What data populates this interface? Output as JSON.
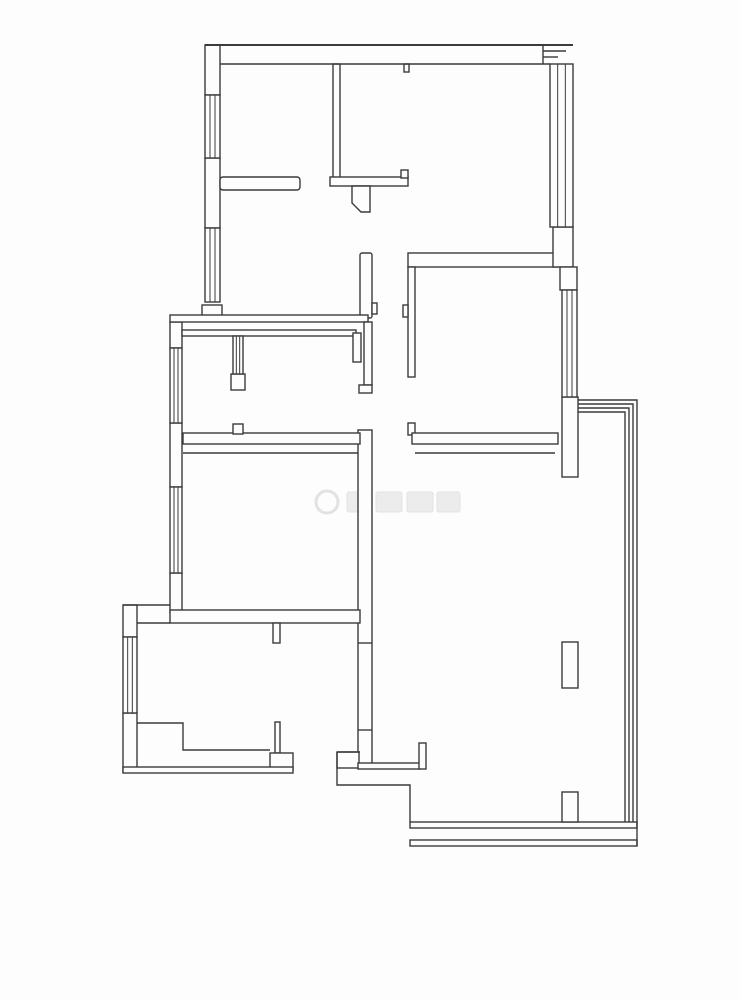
{
  "meta": {
    "title": "apartment-floor-plan"
  },
  "canvas": {
    "w": 740,
    "h": 1000,
    "background": "#fdfdfd",
    "stroke": "#3b3b3b",
    "stroke_thin": 1.4,
    "stroke_thick": 2
  },
  "floorplan": {
    "wall_rects": [
      {
        "name": "wall-left-top-block",
        "x": 205,
        "y": 45,
        "w": 15,
        "h": 50
      },
      {
        "name": "wall-left-mid-block",
        "x": 205,
        "y": 158,
        "w": 15,
        "h": 70
      },
      {
        "name": "wall-left-step-block",
        "x": 202,
        "y": 305,
        "w": 20,
        "h": 12
      },
      {
        "name": "wall-left2-upper-block",
        "x": 170,
        "y": 322,
        "w": 12,
        "h": 26
      },
      {
        "name": "wall-left2-mid-block",
        "x": 170,
        "y": 423,
        "w": 12,
        "h": 64
      },
      {
        "name": "wall-left2-lower-block",
        "x": 170,
        "y": 573,
        "w": 12,
        "h": 40
      },
      {
        "name": "wall-left3-upper-block",
        "x": 123,
        "y": 605,
        "w": 14,
        "h": 32
      },
      {
        "name": "wall-left3-lower-block",
        "x": 123,
        "y": 713,
        "w": 14,
        "h": 59
      },
      {
        "name": "wall-bedroom1-bottom",
        "x": 220,
        "y": 177,
        "w": 80,
        "h": 13,
        "rx": 3
      },
      {
        "name": "wall-partition-top",
        "x": 333,
        "y": 64,
        "w": 7,
        "h": 114
      },
      {
        "name": "wall-hall-bar",
        "x": 330,
        "y": 177,
        "w": 78,
        "h": 9
      },
      {
        "name": "wall-hall-bar-hook",
        "x": 401,
        "y": 170,
        "w": 7,
        "h": 8
      },
      {
        "name": "door-stop-top",
        "x": 404,
        "y": 64,
        "w": 5,
        "h": 8
      },
      {
        "name": "wall-hall-jamb",
        "x": 360,
        "y": 253,
        "w": 12,
        "h": 65,
        "rx": 2
      },
      {
        "name": "door-hinge-hall",
        "x": 372,
        "y": 303,
        "w": 5,
        "h": 11
      },
      {
        "name": "wall-dining-bottom-outer",
        "x": 170,
        "y": 315,
        "w": 198,
        "h": 7
      },
      {
        "name": "wall-dining-bottom-inner",
        "x": 182,
        "y": 330,
        "w": 174,
        "h": 6
      },
      {
        "name": "bath-divider-box",
        "x": 231,
        "y": 374,
        "w": 14,
        "h": 16
      },
      {
        "name": "wall-bath-jamb",
        "x": 353,
        "y": 333,
        "w": 8,
        "h": 29
      },
      {
        "name": "wall-corridor-left-upper",
        "x": 364,
        "y": 322,
        "w": 8,
        "h": 63
      },
      {
        "name": "wall-corridor-left-foot",
        "x": 359,
        "y": 385,
        "w": 13,
        "h": 8
      },
      {
        "name": "wall-living-left",
        "x": 358,
        "y": 430,
        "w": 14,
        "h": 337
      },
      {
        "name": "wall-bath-bottom",
        "x": 183,
        "y": 433,
        "w": 177,
        "h": 11
      },
      {
        "name": "wall-bath-bottom-notch",
        "x": 233,
        "y": 424,
        "w": 10,
        "h": 10
      },
      {
        "name": "wall-bigroom-bottom",
        "x": 170,
        "y": 610,
        "w": 190,
        "h": 13
      },
      {
        "name": "door-jamb-kitchen-top",
        "x": 273,
        "y": 623,
        "w": 7,
        "h": 20
      },
      {
        "name": "door-jamb-entry",
        "x": 275,
        "y": 722,
        "w": 5,
        "h": 31
      },
      {
        "name": "wall-entry-left-block",
        "x": 270,
        "y": 753,
        "w": 23,
        "h": 17
      },
      {
        "name": "wall-kitchen-bottom-outer",
        "x": 123,
        "y": 767,
        "w": 170,
        "h": 6
      },
      {
        "name": "wall-entry-step-block",
        "x": 337,
        "y": 752,
        "w": 22,
        "h": 16
      },
      {
        "name": "wall-living-bottom",
        "x": 358,
        "y": 763,
        "w": 62,
        "h": 6
      },
      {
        "name": "door-jamb-living-bottom",
        "x": 419,
        "y": 743,
        "w": 7,
        "h": 26
      },
      {
        "name": "wall-bedroom2-top",
        "x": 408,
        "y": 253,
        "w": 150,
        "h": 14
      },
      {
        "name": "wall-bedroom2-left",
        "x": 408,
        "y": 267,
        "w": 7,
        "h": 110
      },
      {
        "name": "door-hinge-bedroom2",
        "x": 403,
        "y": 305,
        "w": 5,
        "h": 12
      },
      {
        "name": "door-jamb-bedroom2",
        "x": 408,
        "y": 423,
        "w": 7,
        "h": 12
      },
      {
        "name": "wall-bedroom2-bottom",
        "x": 412,
        "y": 433,
        "w": 146,
        "h": 11
      },
      {
        "name": "wall-right-block-upper",
        "x": 553,
        "y": 227,
        "w": 20,
        "h": 40
      },
      {
        "name": "wall-right-block-mid",
        "x": 560,
        "y": 267,
        "w": 17,
        "h": 23
      },
      {
        "name": "wall-right-block-lower",
        "x": 562,
        "y": 397,
        "w": 16,
        "h": 80
      },
      {
        "name": "wall-balcony-bottom-inner",
        "x": 410,
        "y": 822,
        "w": 227,
        "h": 6
      },
      {
        "name": "wall-balcony-bottom-outer",
        "x": 410,
        "y": 840,
        "w": 227,
        "h": 6
      },
      {
        "name": "column-balcony",
        "x": 562,
        "y": 642,
        "w": 16,
        "h": 46
      },
      {
        "name": "wall-balcony-stub",
        "x": 562,
        "y": 792,
        "w": 16,
        "h": 30
      }
    ],
    "wall_polygons": [
      {
        "name": "wall-hall-pillar",
        "points": "352,186 370,186 370,212 361,212 352,203"
      }
    ],
    "wall_lines": [
      {
        "name": "wall-top-outer",
        "x1": 205,
        "y1": 45,
        "x2": 573,
        "y2": 45,
        "w": 2
      },
      {
        "name": "wall-top-inner",
        "x1": 220,
        "y1": 64,
        "x2": 550,
        "y2": 64
      },
      {
        "name": "wall-top-corner-seam",
        "x1": 543,
        "y1": 45,
        "x2": 543,
        "y2": 64
      },
      {
        "name": "wall-top-corner-step1",
        "x1": 543,
        "y1": 51,
        "x2": 566,
        "y2": 51
      },
      {
        "name": "wall-top-corner-step2",
        "x1": 543,
        "y1": 57,
        "x2": 558,
        "y2": 57
      },
      {
        "name": "wall-bath-bottom-inner",
        "x1": 183,
        "y1": 453,
        "x2": 358,
        "y2": 453
      },
      {
        "name": "wall-bedroom2-bottom-inner",
        "x1": 415,
        "y1": 453,
        "x2": 555,
        "y2": 453
      },
      {
        "name": "wall-kitchen-top-inner",
        "x1": 137,
        "y1": 623,
        "x2": 170,
        "y2": 623
      },
      {
        "name": "wall-kitchen-top-outer",
        "x1": 123,
        "y1": 605,
        "x2": 170,
        "y2": 605
      },
      {
        "name": "door-tick-kitchen-upper",
        "x1": 358,
        "y1": 643,
        "x2": 372,
        "y2": 643
      },
      {
        "name": "door-tick-kitchen-lower",
        "x1": 358,
        "y1": 730,
        "x2": 372,
        "y2": 730
      },
      {
        "name": "wall-balcony-right-close",
        "x1": 637,
        "y1": 822,
        "x2": 637,
        "y2": 846
      },
      {
        "name": "wall-entry-step-top",
        "x1": 337,
        "y1": 752,
        "x2": 360,
        "y2": 752
      }
    ],
    "wall_polylines": [
      {
        "name": "boundary-entry-step",
        "points": "337,752 337,785 410,785 410,822"
      },
      {
        "name": "kitchen-bottom-inner-face",
        "points": "137,723 183,723 183,750 270,750"
      },
      {
        "name": "balcony-glass-line-1",
        "points": "578,400 637,400 637,822"
      },
      {
        "name": "balcony-glass-line-2",
        "points": "578,404 633,404 633,822"
      },
      {
        "name": "balcony-glass-line-3",
        "points": "578,408 629,408 629,822"
      },
      {
        "name": "balcony-glass-line-4",
        "points": "578,412 625,412 625,822"
      }
    ],
    "windows": [
      {
        "name": "window-bedroom1",
        "x": 205,
        "y": 95,
        "w": 15,
        "h": 63
      },
      {
        "name": "window-dining",
        "x": 205,
        "y": 228,
        "w": 15,
        "h": 74
      },
      {
        "name": "window-bath",
        "x": 170,
        "y": 348,
        "w": 12,
        "h": 75
      },
      {
        "name": "window-bigroom",
        "x": 170,
        "y": 487,
        "w": 12,
        "h": 86
      },
      {
        "name": "window-kitchen",
        "x": 123,
        "y": 637,
        "w": 14,
        "h": 76
      },
      {
        "name": "window-right-top",
        "x": 550,
        "y": 64,
        "w": 23,
        "h": 163
      },
      {
        "name": "window-bedroom2",
        "x": 562,
        "y": 290,
        "w": 15,
        "h": 107
      },
      {
        "name": "window-bath-divider",
        "x": 233,
        "y": 336,
        "w": 10,
        "h": 38
      }
    ],
    "watermark": {
      "color": "#e2e2e2",
      "fill": "#ececec",
      "circle": {
        "cx": 327,
        "cy": 502,
        "r": 11
      },
      "blocks": [
        {
          "x": 347,
          "y": 492,
          "w": 24,
          "h": 20
        },
        {
          "x": 376,
          "y": 492,
          "w": 26,
          "h": 20
        },
        {
          "x": 407,
          "y": 492,
          "w": 26,
          "h": 20
        },
        {
          "x": 437,
          "y": 492,
          "w": 23,
          "h": 20
        }
      ]
    }
  }
}
